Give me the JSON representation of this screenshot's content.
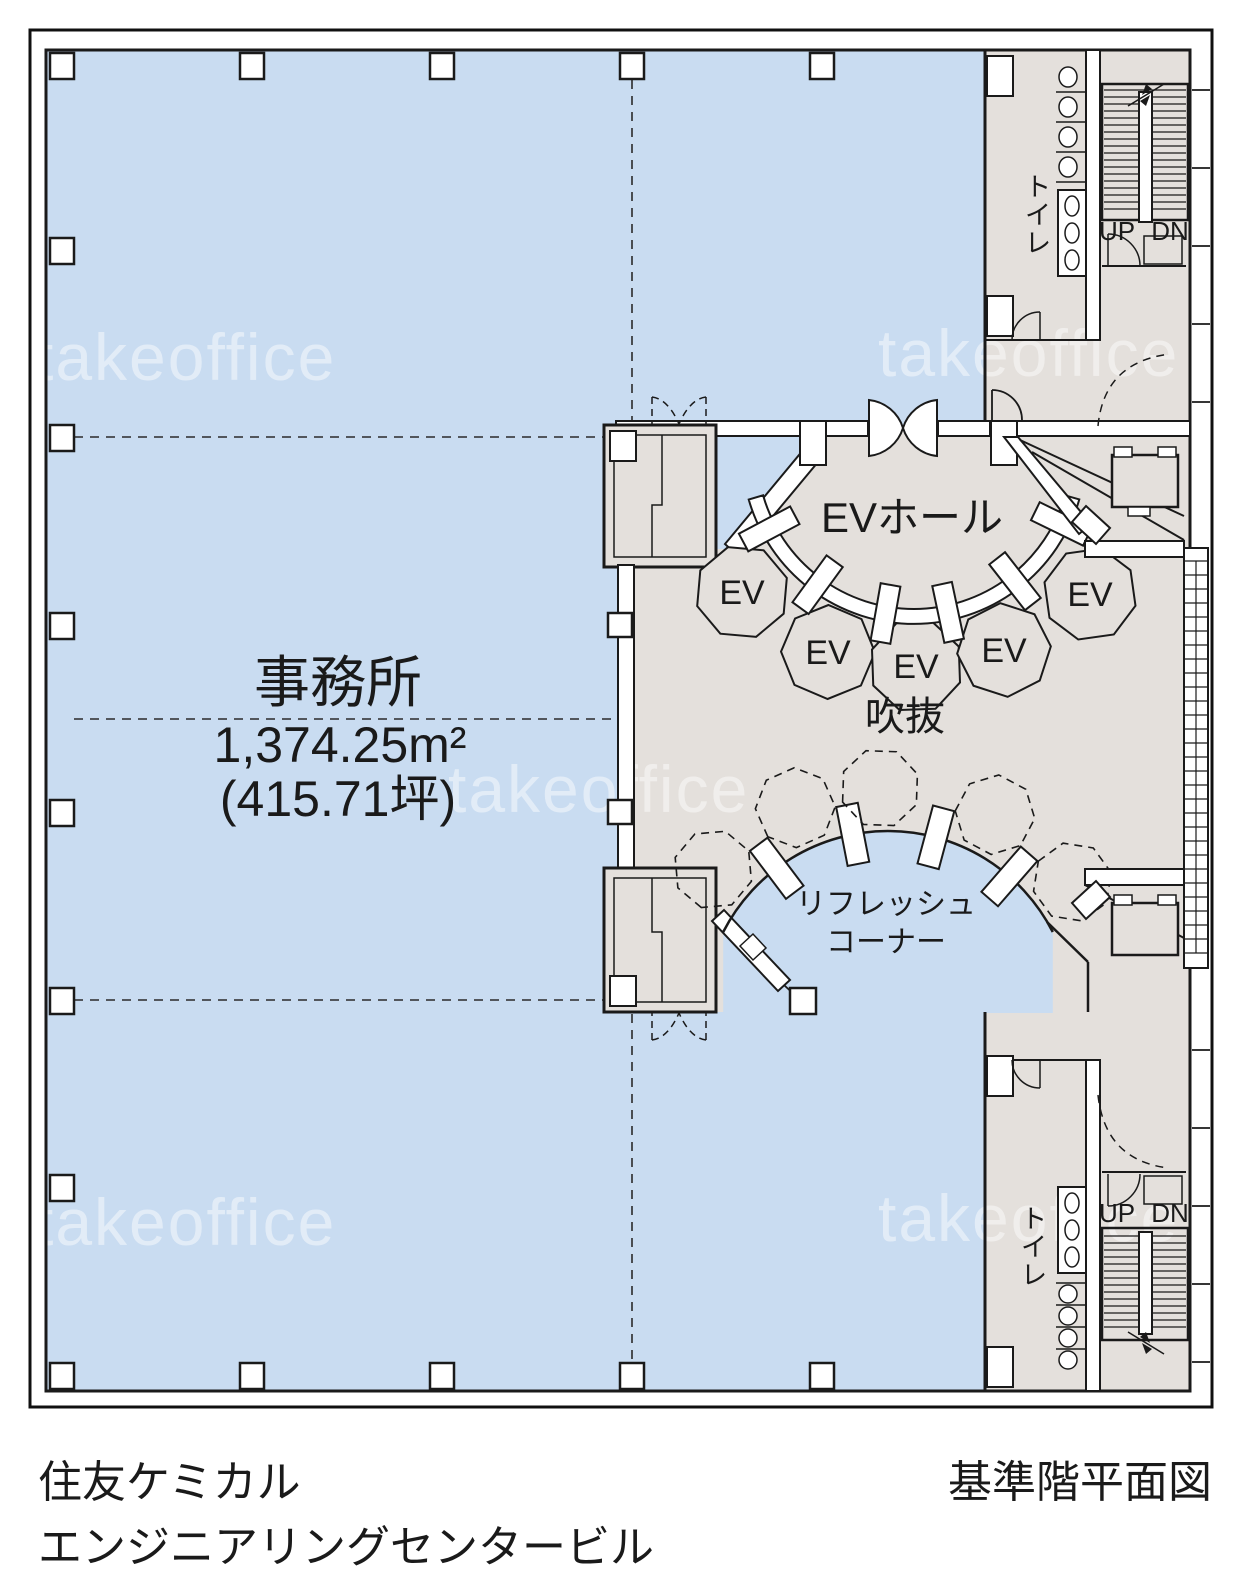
{
  "colors": {
    "office_fill": "#c9dcf1",
    "core_fill": "#e4e0dc",
    "wall": "#1a1a1a",
    "watermark": "#ffffff"
  },
  "watermark": {
    "text": "takeoffice"
  },
  "office": {
    "label": "事務所",
    "area_m2": "1,374.25m²",
    "area_tsubo": "(415.71坪)"
  },
  "ev_hall": {
    "label": "EVホール"
  },
  "atrium": {
    "label": "吹抜"
  },
  "refresh_corner": {
    "line1": "リフレッシュ",
    "line2": "コーナー"
  },
  "elevators": {
    "labels": [
      "EV",
      "EV",
      "EV",
      "EV",
      "EV"
    ]
  },
  "toilet": {
    "label": "トイレ",
    "chars": [
      "ト",
      "イ",
      "レ"
    ]
  },
  "stairs": {
    "up": "UP",
    "down": "DN"
  },
  "footer": {
    "building_name_line1": "住友ケミカル",
    "building_name_line2": "エンジニアリングセンタービル",
    "drawing_title": "基準階平面図"
  }
}
